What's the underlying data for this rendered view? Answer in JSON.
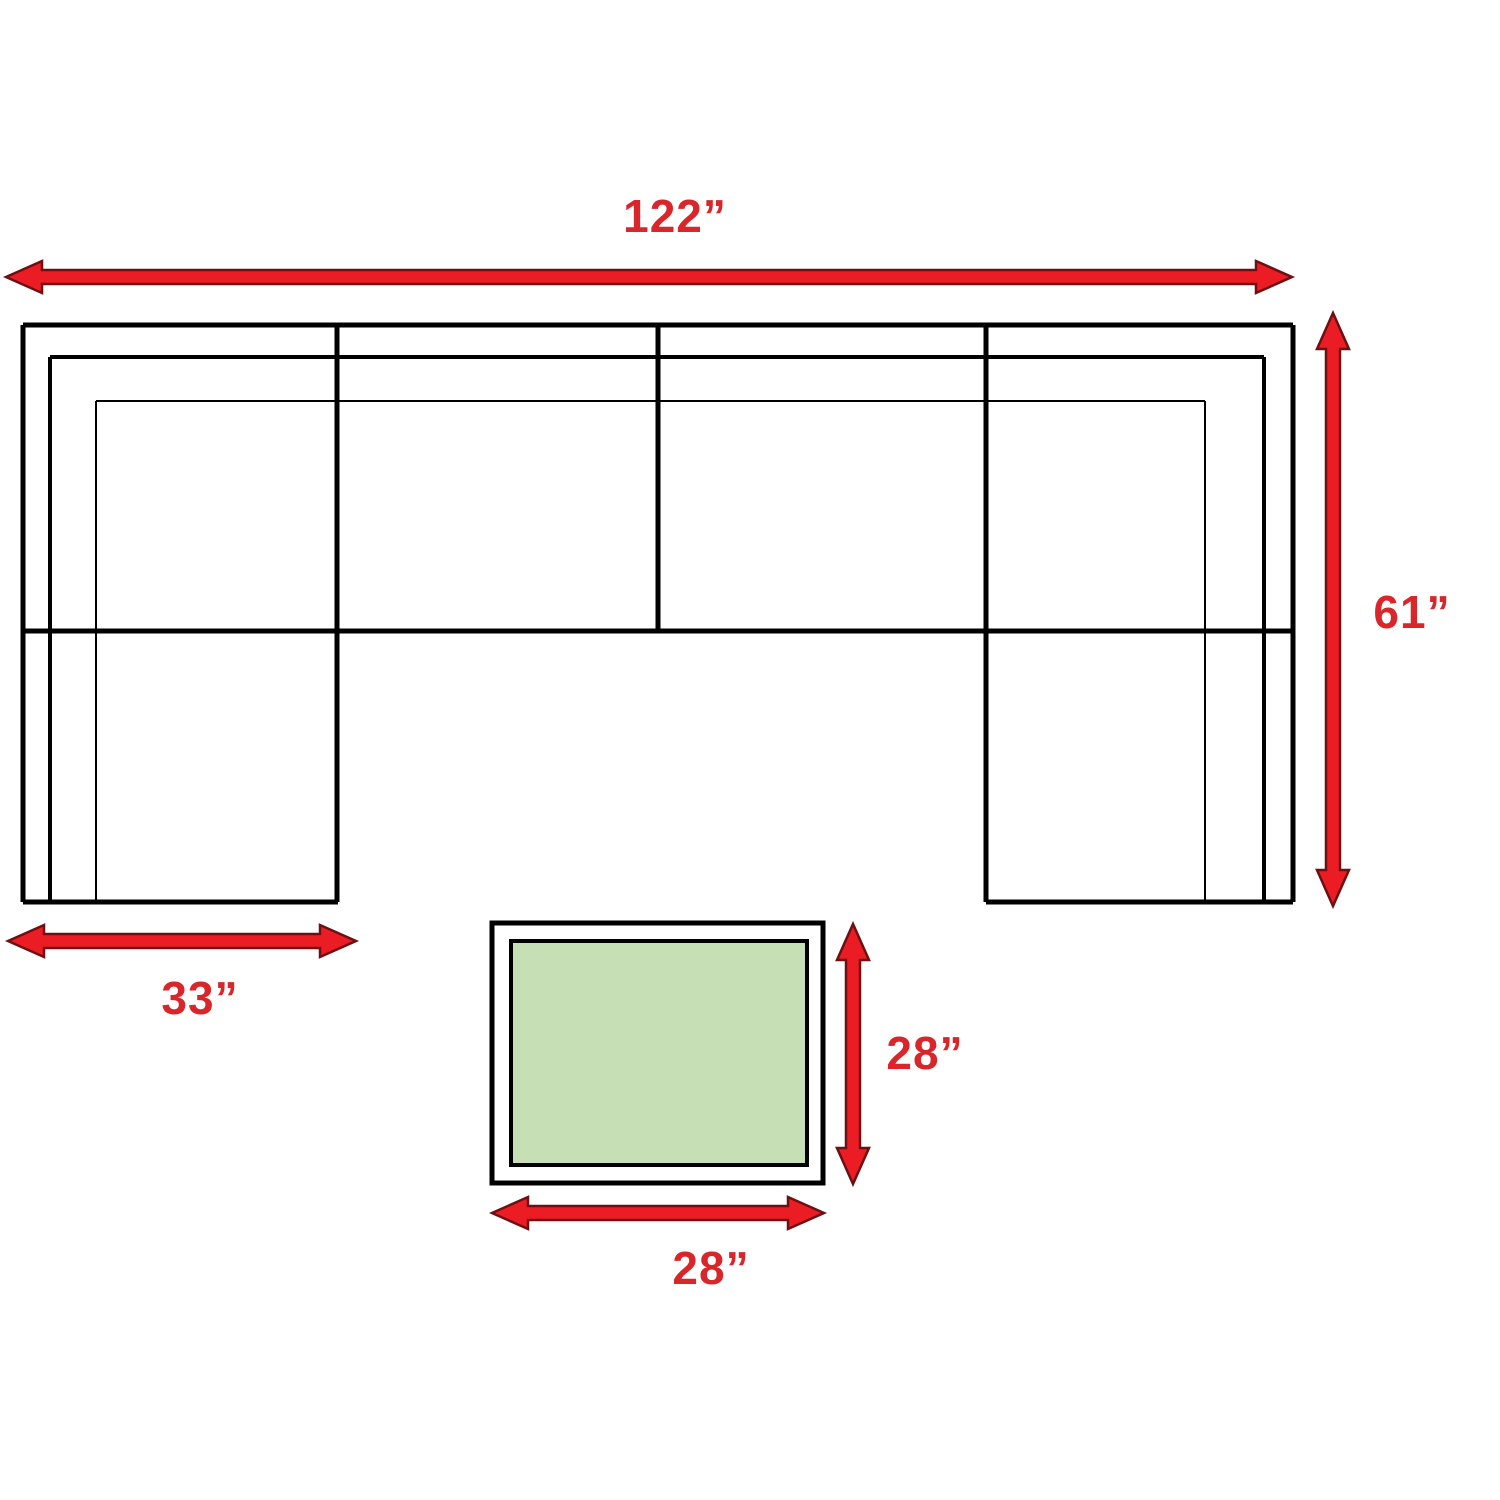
{
  "diagram": {
    "type": "sectional-sofa-dimension-diagram",
    "sofa": {
      "width_label": "122”",
      "depth_label": "61”",
      "chaise_width_label": "33”",
      "section_count": 4
    },
    "table": {
      "depth_label": "28”",
      "width_label": "28”",
      "top_color": "#c6dfb5"
    },
    "colors": {
      "arrow_red": "#ec1c24",
      "arrow_outline": "#6e0f12",
      "label_red": "#d9262b",
      "line_black": "#000000",
      "background": "#ffffff"
    }
  }
}
